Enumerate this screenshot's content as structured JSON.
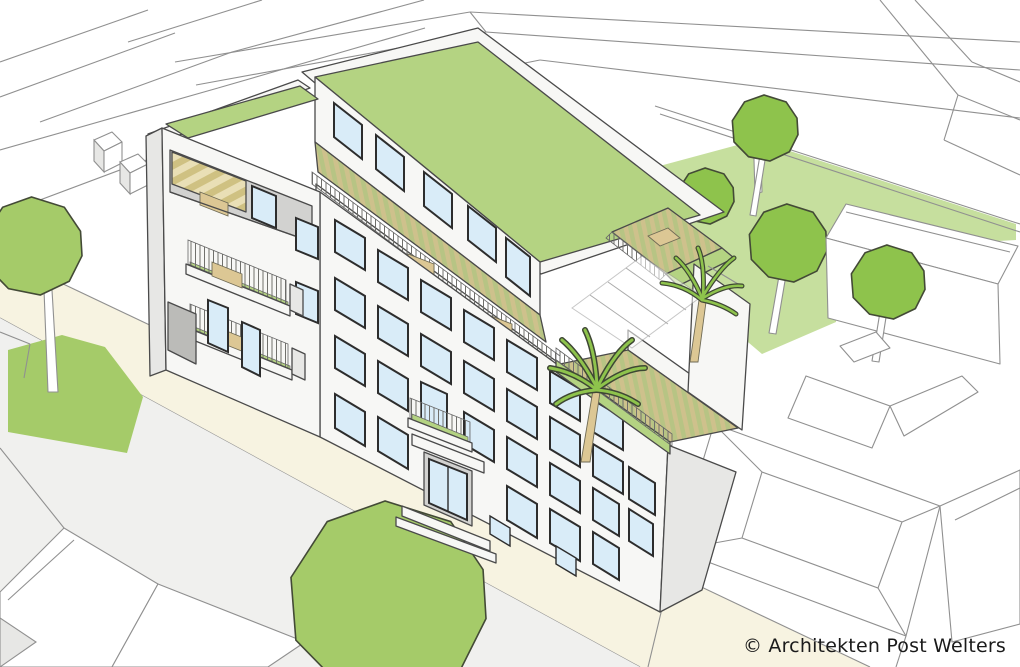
{
  "scene": {
    "kind": "architectural-perspective-rendering",
    "subject": "five-storey apartment building with extensive green roof, balconies, roof terraces with palms, street trees and rear garden",
    "style": "white line-art volumes with green landscape accents"
  },
  "caption": {
    "text": "© Architekten Post Welters"
  },
  "palette": {
    "outline_dark": "#4a4a4a",
    "outline_light": "#909090",
    "facade_white": "#f7f7f5",
    "facade_shadow": "#e7e7e5",
    "window_blue": "#d9ecf8",
    "roof_green": "#b4d382",
    "lawn_green": "#c6df9e",
    "street_green": "#a5cb69",
    "tree_green": "#8ec34c",
    "wood_tan": "#dcc794",
    "street_beige": "#f7f3e1",
    "ground_gray": "#f0f0ee"
  },
  "elements": {
    "main_building": "apartment building with window grid facade",
    "green_roof": "extensive sedum roof",
    "left_tower": "corner tower with loggia and balconies",
    "roof_terrace": "upper deck terrace with tables",
    "palm_terrace": "lower roof terrace with palm trees and glass canopy",
    "entrance": "street entrance with canopy and steps",
    "street": "street with pavement",
    "garden": "rear courtyard lawn with trees",
    "context": "surrounding buildings as outline volumes"
  }
}
